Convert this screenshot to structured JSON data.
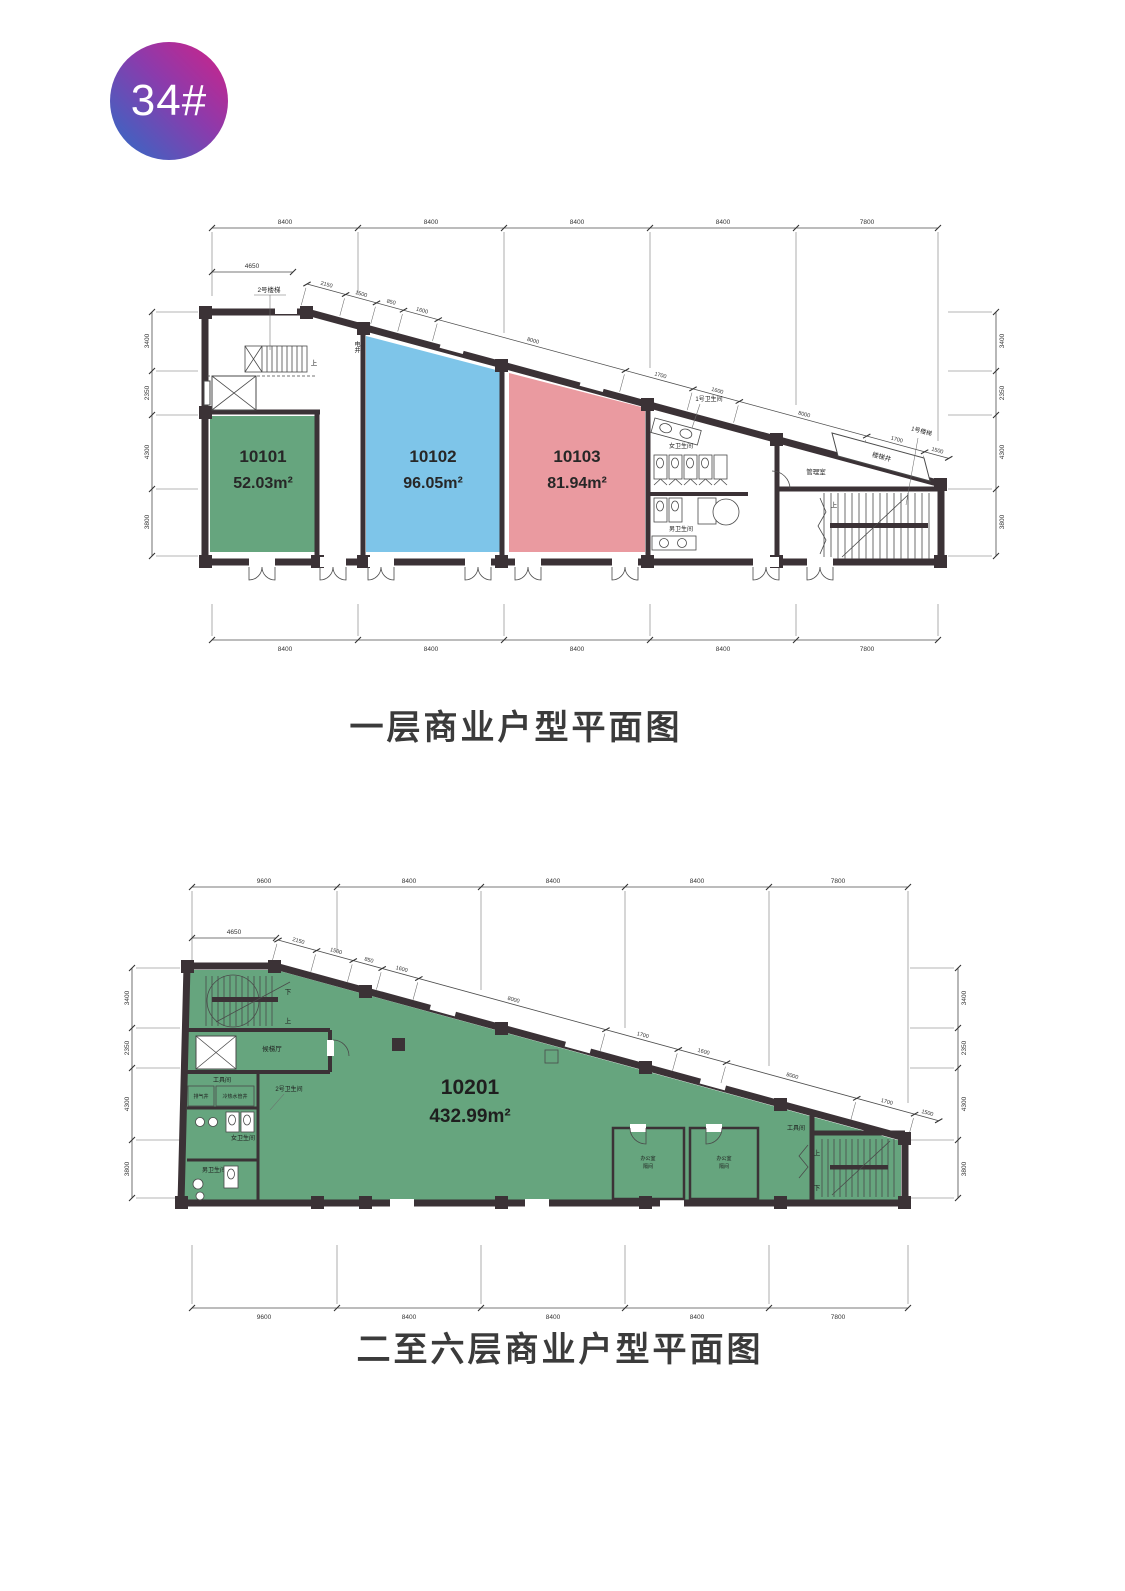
{
  "badge": {
    "label": "34#",
    "gradient_start": "#3a66c3",
    "gradient_end": "#c5268d",
    "text_color": "#ffffff"
  },
  "plan1": {
    "title": "一层商业户型平面图",
    "units": [
      {
        "id": "10101",
        "area": "52.03m²",
        "color": "#66a57e"
      },
      {
        "id": "10102",
        "area": "96.05m²",
        "color": "#7ec5e9"
      },
      {
        "id": "10103",
        "area": "81.94m²",
        "color": "#ea9aa0"
      }
    ],
    "rooms": {
      "stair2": "2号楼梯",
      "elec_shaft": "电井",
      "wc1": "1号卫生间",
      "women": "女卫生间",
      "men": "男卫生间",
      "mgmt": "管理室",
      "stairwell": "楼梯井",
      "stair1": "1号楼梯",
      "up": "上"
    },
    "dims": {
      "top": [
        "8400",
        "8400",
        "8400",
        "8400",
        "7800"
      ],
      "bottom": [
        "8400",
        "8400",
        "8400",
        "8400",
        "7800"
      ],
      "left": [
        "3400",
        "2350",
        "4300",
        "3800"
      ],
      "right": [
        "3400",
        "2350",
        "4300",
        "3800"
      ],
      "left_top": "4650",
      "slant": [
        "2150",
        "1500",
        "850",
        "1600",
        "8000",
        "1700",
        "1600",
        "8000",
        "1700",
        "1500"
      ]
    }
  },
  "plan2": {
    "title": "二至六层商业户型平面图",
    "unit": {
      "id": "10201",
      "area": "432.99m²",
      "color": "#66a57e"
    },
    "rooms": {
      "lobby": "候梯厅",
      "tool_left": "工具间",
      "exhaust": "排气井",
      "water": "冷热水管井",
      "wc2": "2号卫生间",
      "women": "女卫生间",
      "men": "男卫生间",
      "office_line1": "办公室",
      "office_line2": "隔间",
      "tool_right": "工具间",
      "up": "上",
      "down": "下"
    },
    "dims": {
      "top": [
        "9600",
        "8400",
        "8400",
        "8400",
        "7800"
      ],
      "bottom": [
        "9600",
        "8400",
        "8400",
        "8400",
        "7800"
      ],
      "left": [
        "3400",
        "2350",
        "4300",
        "3800"
      ],
      "right": [
        "3400",
        "2350",
        "4300",
        "3800"
      ],
      "left_top": "4650",
      "slant": [
        "2150",
        "1500",
        "850",
        "1600",
        "8000",
        "1700",
        "1600",
        "8000",
        "1700",
        "1500"
      ]
    }
  },
  "wall_color": "#3b3236"
}
